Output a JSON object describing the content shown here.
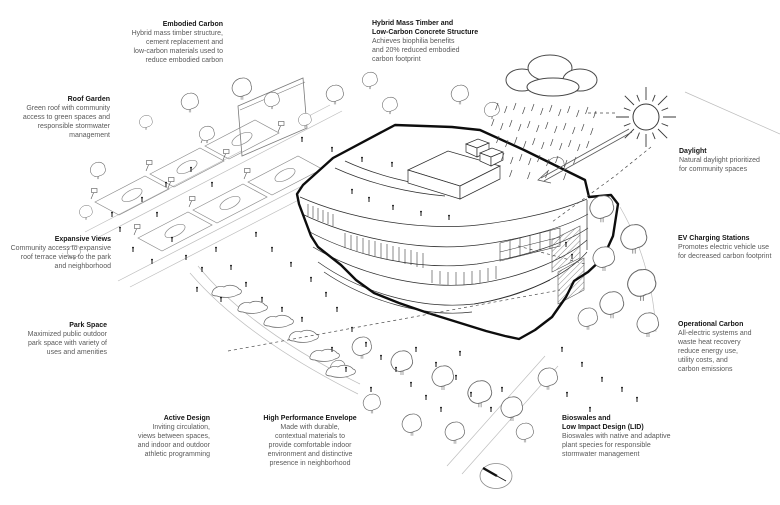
{
  "diagram_type": "architectural sustainability axonometric diagram",
  "colors": {
    "background": "#ffffff",
    "ink": "#111111",
    "line_mid": "#555555",
    "line_light": "#bbbbbb",
    "body_text": "#5a5a5a"
  },
  "icons": {
    "sun": "sun-icon",
    "rain_cloud": "rain-cloud-icon",
    "north_arrow": "north-arrow-compass-icon",
    "sun_ray_arrow": "sun-ray-arrow-icon"
  },
  "annotations": [
    {
      "id": "embodied-carbon",
      "title": "Embodied Carbon",
      "body": "Hybrid mass timber structure,\ncement replacement and\nlow-carbon materials used to\nreduce embodied carbon"
    },
    {
      "id": "hybrid-mass-timber",
      "title": "Hybrid Mass Timber and\nLow-Carbon Concrete Structure",
      "body": "Achieves biophilia benefits\nand 20% reduced embodied\ncarbon footprint"
    },
    {
      "id": "roof-garden",
      "title": "Roof Garden",
      "body": "Green roof with community\naccess to green spaces and\nresponsible stormwater\nmanagement"
    },
    {
      "id": "expansive-views",
      "title": "Expansive Views",
      "body": "Community access to expansive\nroof terrace views to the park\nand neighborhood"
    },
    {
      "id": "park-space",
      "title": "Park Space",
      "body": "Maximized public outdoor\npark space with variety of\nuses and amenities"
    },
    {
      "id": "active-design",
      "title": "Active Design",
      "body": "Inviting circulation,\nviews between spaces,\nand indoor and outdoor\nathletic programming"
    },
    {
      "id": "high-performance-envelope",
      "title": "High Performance Envelope",
      "body": "Made with durable,\ncontextual materials to\nprovide comfortable indoor\nenvironment and distinctive\npresence in neighborhood"
    },
    {
      "id": "daylight",
      "title": "Daylight",
      "body": "Natural daylight prioritized\nfor community spaces"
    },
    {
      "id": "ev-charging-stations",
      "title": "EV Charging Stations",
      "body": "Promotes electric vehicle use\nfor decreased carbon footprint"
    },
    {
      "id": "operational-carbon",
      "title": "Operational Carbon",
      "body": "All-electric systems and\nwaste heat recovery\nreduce energy use,\nutility costs, and\ncarbon emissions"
    },
    {
      "id": "bioswales-lid",
      "title": "Bioswales and\nLow Impact Design (LID)",
      "body": "Bioswales with native and adaptive\nplant species for responsible\nstormwater management"
    }
  ]
}
